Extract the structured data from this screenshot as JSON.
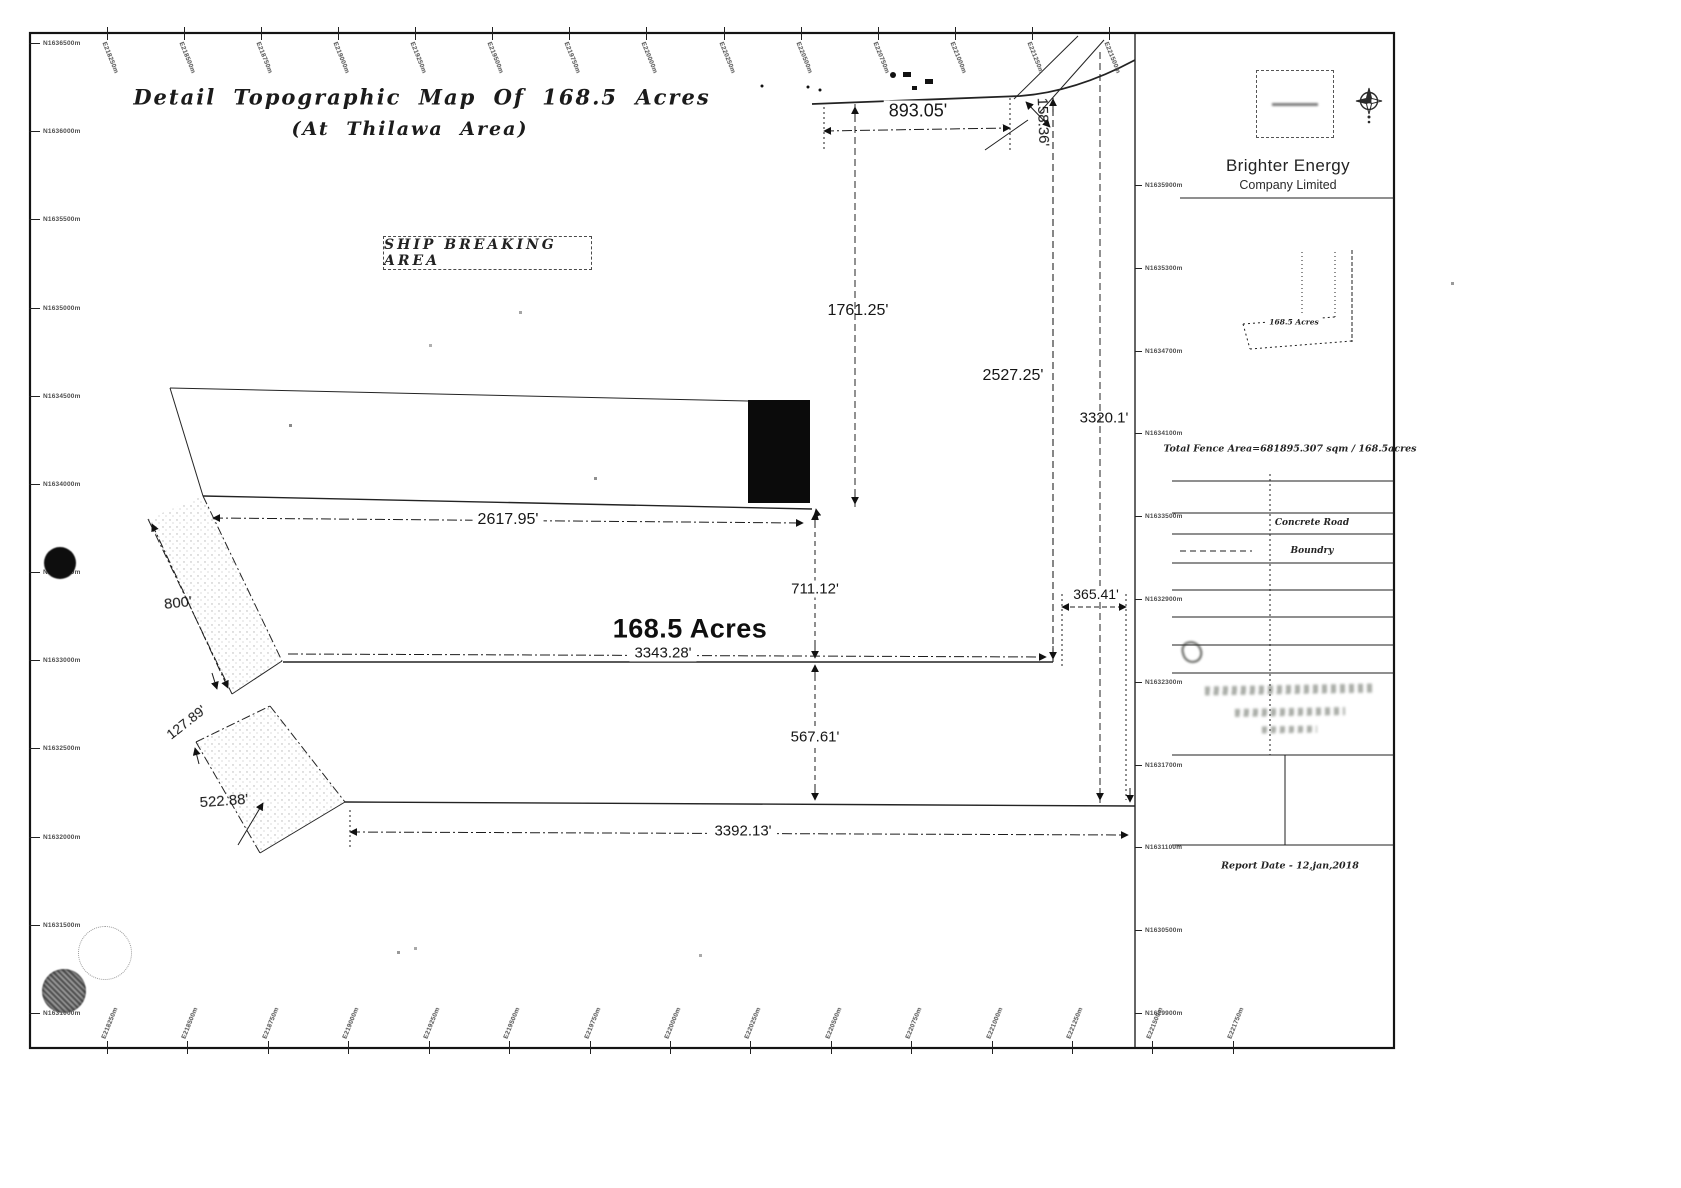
{
  "document": {
    "title_line1": "Detail Topographic Map Of 168.5 Acres",
    "title_line2": "(At Thilawa Area)"
  },
  "map": {
    "ship_breaking_area_label": "SHIP BREAKING AREA",
    "area_label": "168.5 Acres",
    "dimensions": {
      "top_edge": "893.05'",
      "top_right_edge": "158.36'",
      "upper_left_vertical": "1761.25'",
      "right_vertical_inner": "2527.25'",
      "right_vertical_outer": "3320.1'",
      "upper_arm_width": "2617.95'",
      "middle_vertical_upper": "711.12'",
      "middle_vertical_lower": "567.61'",
      "middle_width": "3343.28'",
      "right_offset": "365.41'",
      "bottom_width": "3392.13'",
      "west_strip_length": "800'",
      "west_strip_gap": "127.89'",
      "southwest_strip_length": "522.88'"
    }
  },
  "titleblock": {
    "company_name": "Brighter Energy",
    "company_subtitle": "Company Limited",
    "inset_map_label": "168.5 Acres",
    "total_fence_area": "Total Fence Area=681895.307 sqm / 168.5acres",
    "legend": {
      "concrete_road": "Concrete Road",
      "boundary": "Boundry"
    },
    "report_date": "Report Date - 12,jan,2018"
  },
  "frame": {
    "top_labels": [
      "E218250m",
      "E218500m",
      "E218750m",
      "E219000m",
      "E219250m",
      "E219500m",
      "E219750m",
      "E220000m",
      "E220250m",
      "E220500m",
      "E220750m",
      "E221000m",
      "E221250m",
      "E221500m"
    ],
    "bottom_labels": [
      "E218250m",
      "E218500m",
      "E218750m",
      "E219000m",
      "E219250m",
      "E219500m",
      "E219750m",
      "E220000m",
      "E220250m",
      "E220500m",
      "E220750m",
      "E221000m",
      "E221250m",
      "E221500m",
      "E221750m"
    ],
    "left_labels": [
      "N1636500m",
      "N1636000m",
      "N1635500m",
      "N1635000m",
      "N1634500m",
      "N1634000m",
      "N1633500m",
      "N1633000m",
      "N1632500m",
      "N1632000m",
      "N1631500m",
      "N1631000m"
    ],
    "sidebar_labels": [
      "N1635900m",
      "N1635300m",
      "N1634700m",
      "N1634100m",
      "N1633500m",
      "N1632900m",
      "N1632300m",
      "N1631700m",
      "N1631100m",
      "N1630500m",
      "N1629900m"
    ]
  },
  "colors": {
    "ink": "#1c1c1c",
    "paper": "#ffffff"
  }
}
